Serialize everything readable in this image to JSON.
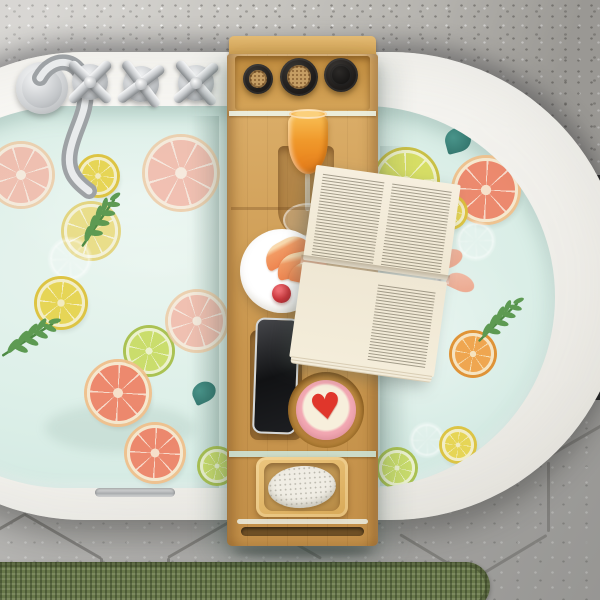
{
  "labels": {
    "scene": "Top-down view of a bamboo bathtub caddy tray across a white oval bathtub filled with pale aqua water, floating citrus slices and green sprigs",
    "wall": "Gray speckled wall",
    "floor": "Gray hexagonal tile floor",
    "rug": "Green woven bath rug",
    "bathtub": "White oval bathtub",
    "water": "Bath water with floating lemon, lime and grapefruit slices",
    "faucet": "Chrome gooseneck bathtub faucet",
    "handles": "Chrome cross-shaped faucet handles",
    "overflow": "Chrome overflow slot on tub rim",
    "tray": "Bamboo bathtub caddy tray",
    "bottle_shelf": "Tray compartment with bottles",
    "bottle_cork_1": "Dark bottle with cork stopper",
    "bottle_cork_2": "Dark bottle with cork stopper",
    "bottle_black": "Black bottle",
    "juice_glass": "Stemmed glass of orange juice in wine-glass slot",
    "plate": "White plate with grapefruit wedges and a cherry",
    "book": "Open book with printed pages on reading rack",
    "book_stand": "Metal book-rest wire",
    "phone": "Smartphone standing in device slot",
    "bath_bomb": "Round bath bomb with red heart",
    "soap_dish": "Bamboo soap dish",
    "soap": "White speckled soap bar",
    "tray_handle": "Tray end handle slot"
  },
  "counts": {
    "handles": 3,
    "bottles": 3,
    "fruit_slices": 19,
    "sprigs": 3
  },
  "tray": {
    "bath_bomb": {
      "heart_glyph": "♥"
    }
  },
  "colors": {
    "wall_gray": "#c7c5c0",
    "tile_gray": "#a8a7a4",
    "grout": "#7b7a77",
    "rug_green": "#68784a",
    "tub_white": "#f7f6f2",
    "water_aqua": "#cfe7e0",
    "water_light": "#e9f5ef",
    "bamboo": "#d3a055",
    "cork_tan": "#c59d63",
    "juice_orange": "#f09a2c",
    "cherry_red": "#c8353a",
    "heart_red": "#e0362b",
    "soap_white": "#f0ede4",
    "book_page": "#f6efdf",
    "leaf_green": "#5d9a52",
    "leaf_teal": "#35796f",
    "chrome": "#c8cbce",
    "bottle_black": "#201d1b"
  },
  "water": {
    "fruits": [
      {
        "type": "gpf-pale",
        "x": 115,
        "y": 38,
        "d": 56
      },
      {
        "type": "lemon",
        "x": 204,
        "y": 51,
        "d": 32
      },
      {
        "type": "lemon-pale",
        "x": 189,
        "y": 98,
        "d": 48
      },
      {
        "type": "white",
        "x": 175,
        "y": 133,
        "d": 36
      },
      {
        "type": "lemon",
        "x": 162,
        "y": 173,
        "d": 42
      },
      {
        "type": "gpf-pale",
        "x": 270,
        "y": 31,
        "d": 66
      },
      {
        "type": "lime",
        "x": 251,
        "y": 222,
        "d": 40
      },
      {
        "type": "gpf-pale",
        "x": 293,
        "y": 186,
        "d": 52
      },
      {
        "type": "gpf",
        "x": 212,
        "y": 256,
        "d": 56
      },
      {
        "type": "gpf",
        "x": 252,
        "y": 319,
        "d": 50
      },
      {
        "type": "lime",
        "x": 325,
        "y": 343,
        "d": 28
      },
      {
        "type": "lemonlime",
        "x": 500,
        "y": 44,
        "d": 56
      },
      {
        "type": "gpf",
        "x": 579,
        "y": 52,
        "d": 58
      },
      {
        "type": "lemon",
        "x": 560,
        "y": 91,
        "d": 24
      },
      {
        "type": "white",
        "x": 583,
        "y": 117,
        "d": 32
      },
      {
        "type": "orange",
        "x": 577,
        "y": 227,
        "d": 36
      },
      {
        "type": "white",
        "x": 536,
        "y": 318,
        "d": 28
      },
      {
        "type": "lemon",
        "x": 567,
        "y": 323,
        "d": 26
      },
      {
        "type": "lime",
        "x": 504,
        "y": 344,
        "d": 30
      }
    ],
    "sprigs": [
      {
        "x": 200,
        "y": 92,
        "rot": -15,
        "scale": 1.0
      },
      {
        "x": 130,
        "y": 210,
        "rot": 8,
        "scale": 1.05
      },
      {
        "x": 600,
        "y": 192,
        "rot": -4,
        "scale": 0.95
      }
    ],
    "teal_leaves": [
      {
        "x": 570,
        "y": 22,
        "w": 26,
        "h": 24,
        "rot": -15
      },
      {
        "x": 317,
        "y": 276,
        "w": 24,
        "h": 20,
        "rot": -25
      }
    ],
    "wedge_bits": [
      {
        "x": 558,
        "y": 144,
        "w": 30,
        "h": 18,
        "rot": -20
      },
      {
        "x": 572,
        "y": 168,
        "w": 28,
        "h": 17,
        "rot": 25
      }
    ]
  },
  "floor": {
    "grout": [
      {
        "x": 168,
        "y": 156,
        "len": 88,
        "rot": -30
      },
      {
        "x": 245,
        "y": 113,
        "len": 88,
        "rot": 30
      },
      {
        "x": 167,
        "y": 158,
        "len": 44,
        "rot": 0,
        "v": true
      },
      {
        "x": 25,
        "y": 113,
        "len": 88,
        "rot": 30
      },
      {
        "x": -50,
        "y": 156,
        "len": 88,
        "rot": -30
      },
      {
        "x": 100,
        "y": 158,
        "len": 12,
        "rot": 0,
        "v": true
      },
      {
        "x": 400,
        "y": 133,
        "len": 86,
        "rot": 31
      },
      {
        "x": 473,
        "y": 178,
        "len": 86,
        "rot": -31
      },
      {
        "x": 472,
        "y": 178,
        "len": 24,
        "rot": 0,
        "v": true
      },
      {
        "x": 547,
        "y": 62,
        "len": 70,
        "rot": 0,
        "v": true
      },
      {
        "x": 548,
        "y": 55,
        "len": 62,
        "rot": -30
      }
    ]
  },
  "handles_pos": [
    {
      "x": 61,
      "y": 53,
      "rot": 0
    },
    {
      "x": 112,
      "y": 55,
      "rot": 8
    },
    {
      "x": 167,
      "y": 54,
      "rot": 4
    }
  ]
}
